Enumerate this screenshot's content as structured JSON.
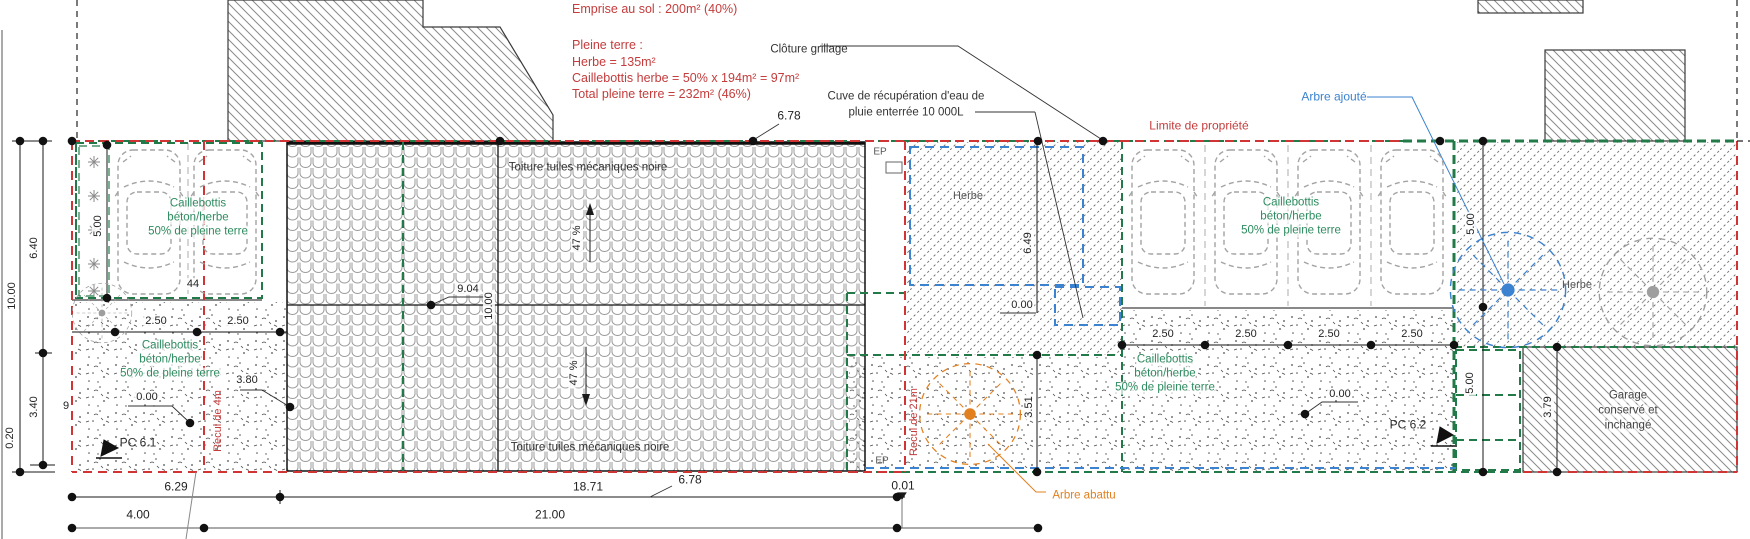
{
  "plan": {
    "summary": {
      "emprise": "Emprise au sol : 200m² (40%)",
      "pleine_terre_title": "Pleine terre :",
      "herbe": "Herbe = 135m²",
      "caillebottis_herbe": "Caillebottis herbe = 50% x 194m² = 97m²",
      "total_pleine_terre": "Total pleine terre = 232m² (46%)"
    },
    "annotations": {
      "cloture_grillage": "Clôture grillage",
      "cuve_line1": "Cuve de récupération d'eau de",
      "cuve_line2": "pluie enterrée 10 000L",
      "limite_propriete": "Limite de propriété",
      "arbre_ajoute": "Arbre ajouté",
      "arbre_abattu": "Arbre abattu",
      "toiture": "Toiture tuiles mécaniques noire",
      "herbe": "Herbe",
      "ep": "EP",
      "pc_6_1": "PC 6.1",
      "pc_6_2": "PC 6.2",
      "recul_4m": "Recul de 4m",
      "recul_21m": "Recul de 21m",
      "garage_line1": "Garage",
      "garage_line2": "conservé et",
      "garage_line3": "inchangé",
      "caillebottis_line1": "Caillebottis",
      "caillebottis_line2": "béton/herbe",
      "caillebottis_line3": "50% de pleine terre",
      "pente": "47 %",
      "place_number": "44"
    },
    "dimensions": {
      "top_width": "6.78",
      "roof_left_width": "9.04",
      "roof_depth": "10.00",
      "left_total": "10.00",
      "left_upper": "6.40",
      "left_lower": "3.40",
      "left_offset": "0.20",
      "left_side": "9",
      "hedge_depth": "5.00",
      "stall_width": "2.50",
      "level_zero": "0.00",
      "drive_width": "3.80",
      "herbe_depth": "6.49",
      "tree_offset": "3.51",
      "right_half": "5.00",
      "garage_side": "3.79",
      "bottom_left": "6.29",
      "bottom_mid": "18.71",
      "bottom_roof": "6.78",
      "bottom_gap": "0.01",
      "bottom_row2_left": "4.00",
      "bottom_row2_mid": "21.00"
    },
    "colors": {
      "boundary_red": "#d03434",
      "hedge_green": "#217a48",
      "text_green": "#2e8b5f",
      "tree_added_blue": "#3b82d0",
      "tree_removed_orange": "#e2801f",
      "annotation_red": "#c43c3c"
    }
  }
}
